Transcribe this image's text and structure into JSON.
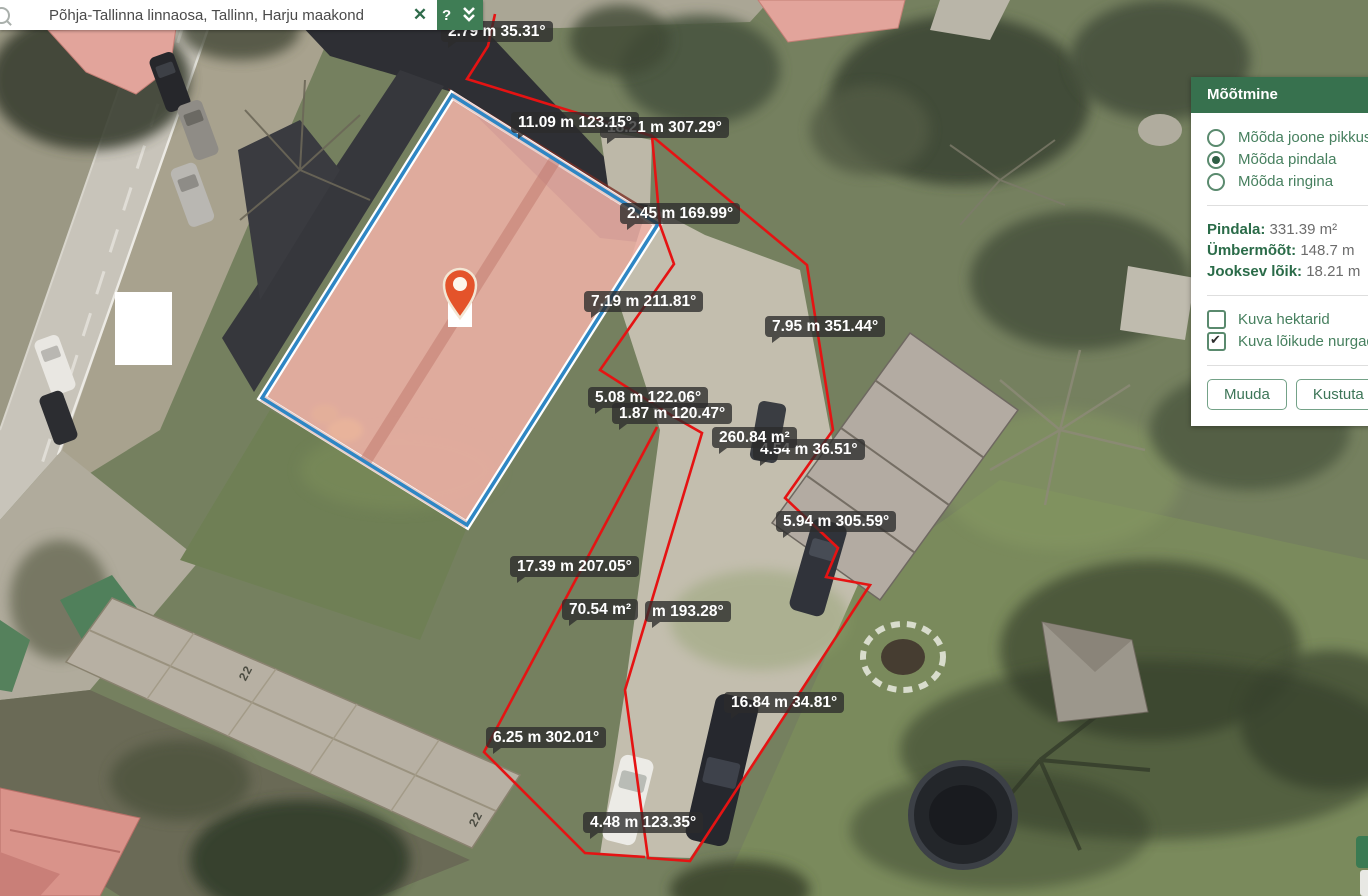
{
  "top_bar": {
    "search_value": "Põhja-Tallinna linnaosa, Tallinn, Harju maakond",
    "close_label": "✕",
    "help_label": "?"
  },
  "panel": {
    "title": "Mõõtmine",
    "radios": [
      {
        "label": "Mõõda joone pikkust",
        "selected": false
      },
      {
        "label": "Mõõda pindala",
        "selected": true
      },
      {
        "label": "Mõõda ringina",
        "selected": false
      }
    ],
    "results": [
      {
        "label": "Pindala:",
        "value": "331.39 m²"
      },
      {
        "label": "Ümbermõõt:",
        "value": "148.7 m"
      },
      {
        "label": "Jooksev lõik:",
        "value": "18.21 m"
      }
    ],
    "checkboxes": [
      {
        "label": "Kuva hektarid",
        "checked": false
      },
      {
        "label": "Kuva lõikude nurgad ja",
        "checked": true
      }
    ],
    "buttons": [
      {
        "label": "Muuda"
      },
      {
        "label": "Kustuta"
      },
      {
        "label": ""
      }
    ]
  },
  "map": {
    "measurement_labels": [
      {
        "text": "2.79 m 35.31°",
        "x": 441,
        "y": 21
      },
      {
        "text": "11.09 m 123.15°",
        "x": 511,
        "y": 112,
        "z": 6
      },
      {
        "text": "18.21 m 307.29°",
        "x": 600,
        "y": 117,
        "z": 5
      },
      {
        "text": "2.45 m 169.99°",
        "x": 620,
        "y": 203
      },
      {
        "text": "7.19 m 211.81°",
        "x": 584,
        "y": 291
      },
      {
        "text": "7.95 m 351.44°",
        "x": 765,
        "y": 316
      },
      {
        "text": "5.08 m 122.06°",
        "x": 588,
        "y": 387
      },
      {
        "text": "1.87 m 120.47°",
        "x": 612,
        "y": 403
      },
      {
        "text": "260.84 m²",
        "x": 712,
        "y": 427,
        "z": 6
      },
      {
        "text": "4.54 m 36.51°",
        "x": 753,
        "y": 439,
        "z": 5
      },
      {
        "text": "5.94 m 305.59°",
        "x": 776,
        "y": 511
      },
      {
        "text": "17.39 m 207.05°",
        "x": 510,
        "y": 556
      },
      {
        "text": "70.54 m²",
        "x": 562,
        "y": 599,
        "z": 6
      },
      {
        "text": "m 193.28°",
        "x": 645,
        "y": 601,
        "z": 5
      },
      {
        "text": "16.84 m 34.81°",
        "x": 724,
        "y": 692
      },
      {
        "text": "6.25 m 302.01°",
        "x": 486,
        "y": 727
      },
      {
        "text": "4.48 m 123.35°",
        "x": 583,
        "y": 812
      }
    ],
    "house_numbers": [
      {
        "text": "22",
        "x": 238,
        "y": 666
      },
      {
        "text": "22",
        "x": 468,
        "y": 812
      }
    ]
  },
  "colors": {
    "brand_green": "#37714e",
    "accent_blue": "#2e86c4",
    "measure_red": "#e51313",
    "pin_orange": "#e4532a"
  }
}
